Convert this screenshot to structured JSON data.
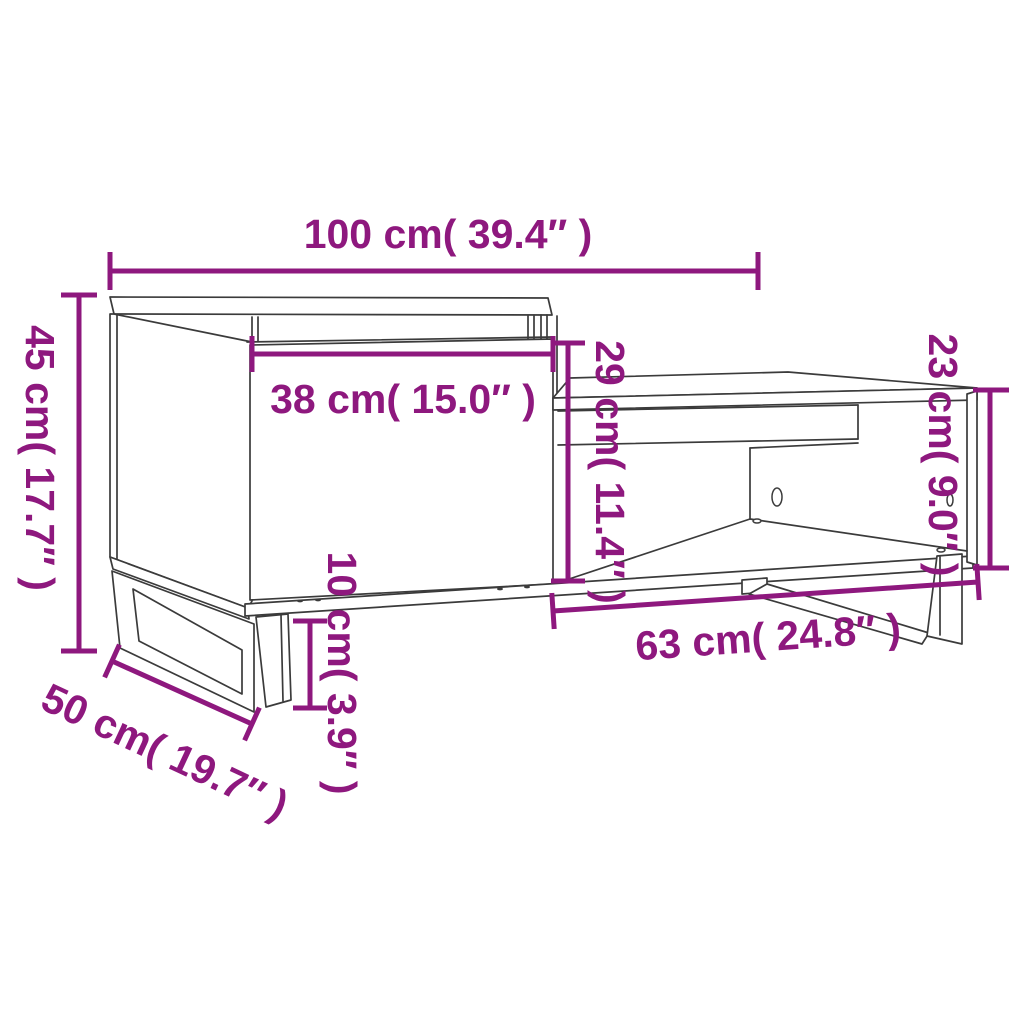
{
  "diagram": {
    "type": "furniture-dimension-drawing",
    "subject": "coffee table with cabinet and open shelf",
    "colors": {
      "background": "#ffffff",
      "dimension_annotations": "#8e187e",
      "furniture_outline": "#3b3b3b"
    },
    "dimensions": {
      "total_width": {
        "cm": 100,
        "inch": 39.4,
        "label": "100 cm( 39.4″ )"
      },
      "cabinet_height": {
        "cm": 45,
        "inch": 17.7,
        "label": "45 cm( 17.7″ )"
      },
      "depth": {
        "cm": 50,
        "inch": 19.7,
        "label": "50 cm( 19.7″ )"
      },
      "door_width": {
        "cm": 38,
        "inch": 15.0,
        "label": "38 cm( 15.0″ )"
      },
      "opening_height": {
        "cm": 29,
        "inch": 11.4,
        "label": "29 cm( 11.4″ )"
      },
      "leg_height": {
        "cm": 10,
        "inch": 3.9,
        "label": "10 cm( 3.9″ )"
      },
      "shelf_width": {
        "cm": 63,
        "inch": 24.8,
        "label": "63 cm( 24.8″ )"
      },
      "table_height": {
        "cm": 23,
        "inch": 9.0,
        "label": "23 cm( 9.0″ )"
      }
    }
  }
}
